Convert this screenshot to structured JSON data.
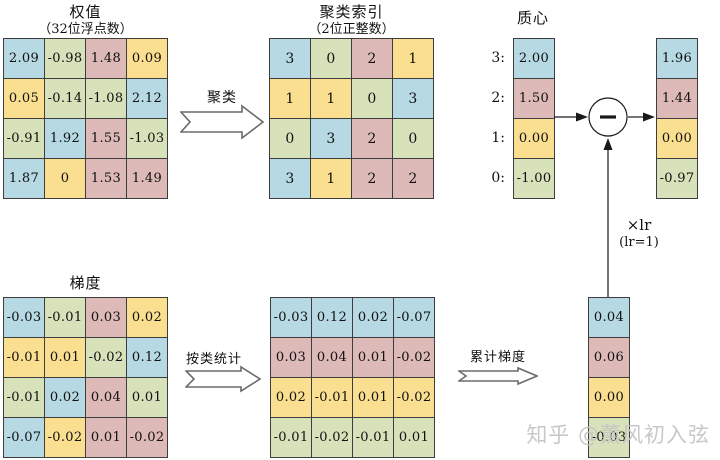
{
  "colors": {
    "blue": "#b6d9e3",
    "green": "#d7e2ba",
    "pink": "#ddb9b8",
    "yellow": "#fbdf90"
  },
  "weights": {
    "title": "权值",
    "subtitle": "（32位浮点数）",
    "cells": [
      [
        {
          "v": "2.09",
          "c": "blue"
        },
        {
          "v": "-0.98",
          "c": "green"
        },
        {
          "v": "1.48",
          "c": "pink"
        },
        {
          "v": "0.09",
          "c": "yellow"
        }
      ],
      [
        {
          "v": "0.05",
          "c": "yellow"
        },
        {
          "v": "-0.14",
          "c": "green"
        },
        {
          "v": "-1.08",
          "c": "green"
        },
        {
          "v": "2.12",
          "c": "blue"
        }
      ],
      [
        {
          "v": "-0.91",
          "c": "green"
        },
        {
          "v": "1.92",
          "c": "blue"
        },
        {
          "v": "1.55",
          "c": "pink"
        },
        {
          "v": "-1.03",
          "c": "green"
        }
      ],
      [
        {
          "v": "1.87",
          "c": "blue"
        },
        {
          "v": "0",
          "c": "yellow"
        },
        {
          "v": "1.53",
          "c": "pink"
        },
        {
          "v": "1.49",
          "c": "pink"
        }
      ]
    ]
  },
  "cluster_index": {
    "title": "聚类索引",
    "subtitle": "（2位正整数）",
    "cells": [
      [
        {
          "v": "3",
          "c": "blue"
        },
        {
          "v": "0",
          "c": "green"
        },
        {
          "v": "2",
          "c": "pink"
        },
        {
          "v": "1",
          "c": "yellow"
        }
      ],
      [
        {
          "v": "1",
          "c": "yellow"
        },
        {
          "v": "1",
          "c": "yellow"
        },
        {
          "v": "0",
          "c": "green"
        },
        {
          "v": "3",
          "c": "blue"
        }
      ],
      [
        {
          "v": "0",
          "c": "green"
        },
        {
          "v": "3",
          "c": "blue"
        },
        {
          "v": "2",
          "c": "pink"
        },
        {
          "v": "0",
          "c": "green"
        }
      ],
      [
        {
          "v": "3",
          "c": "blue"
        },
        {
          "v": "1",
          "c": "yellow"
        },
        {
          "v": "2",
          "c": "pink"
        },
        {
          "v": "2",
          "c": "pink"
        }
      ]
    ]
  },
  "centroids": {
    "title": "质心",
    "labels": [
      "3:",
      "2:",
      "1:",
      "0:"
    ],
    "cells": [
      [
        {
          "v": "2.00",
          "c": "blue"
        }
      ],
      [
        {
          "v": "1.50",
          "c": "pink"
        }
      ],
      [
        {
          "v": "0.00",
          "c": "yellow"
        }
      ],
      [
        {
          "v": "-1.00",
          "c": "green"
        }
      ]
    ]
  },
  "updated_centroids": {
    "cells": [
      [
        {
          "v": "1.96",
          "c": "blue"
        }
      ],
      [
        {
          "v": "1.44",
          "c": "pink"
        }
      ],
      [
        {
          "v": "0.00",
          "c": "yellow"
        }
      ],
      [
        {
          "v": "-0.97",
          "c": "green"
        }
      ]
    ]
  },
  "gradients": {
    "title": "梯度",
    "cells": [
      [
        {
          "v": "-0.03",
          "c": "blue"
        },
        {
          "v": "-0.01",
          "c": "green"
        },
        {
          "v": "0.03",
          "c": "pink"
        },
        {
          "v": "0.02",
          "c": "yellow"
        }
      ],
      [
        {
          "v": "-0.01",
          "c": "yellow"
        },
        {
          "v": "0.01",
          "c": "yellow"
        },
        {
          "v": "-0.02",
          "c": "green"
        },
        {
          "v": "0.12",
          "c": "blue"
        }
      ],
      [
        {
          "v": "-0.01",
          "c": "green"
        },
        {
          "v": "0.02",
          "c": "blue"
        },
        {
          "v": "0.04",
          "c": "pink"
        },
        {
          "v": "0.01",
          "c": "green"
        }
      ],
      [
        {
          "v": "-0.07",
          "c": "blue"
        },
        {
          "v": "-0.02",
          "c": "yellow"
        },
        {
          "v": "0.01",
          "c": "pink"
        },
        {
          "v": "-0.02",
          "c": "pink"
        }
      ]
    ]
  },
  "grouped_gradients": {
    "cells": [
      [
        {
          "v": "-0.03",
          "c": "blue"
        },
        {
          "v": "0.12",
          "c": "blue"
        },
        {
          "v": "0.02",
          "c": "blue"
        },
        {
          "v": "-0.07",
          "c": "blue"
        }
      ],
      [
        {
          "v": "0.03",
          "c": "pink"
        },
        {
          "v": "0.04",
          "c": "pink"
        },
        {
          "v": "0.01",
          "c": "pink"
        },
        {
          "v": "-0.02",
          "c": "pink"
        }
      ],
      [
        {
          "v": "0.02",
          "c": "yellow"
        },
        {
          "v": "-0.01",
          "c": "yellow"
        },
        {
          "v": "0.01",
          "c": "yellow"
        },
        {
          "v": "-0.02",
          "c": "yellow"
        }
      ],
      [
        {
          "v": "-0.01",
          "c": "green"
        },
        {
          "v": "-0.02",
          "c": "green"
        },
        {
          "v": "-0.01",
          "c": "green"
        },
        {
          "v": "0.01",
          "c": "green"
        }
      ]
    ]
  },
  "accumulated_gradients": {
    "cells": [
      [
        {
          "v": "0.04",
          "c": "blue"
        }
      ],
      [
        {
          "v": "0.06",
          "c": "pink"
        }
      ],
      [
        {
          "v": "0.00",
          "c": "yellow"
        }
      ],
      [
        {
          "v": "-0.03",
          "c": "green"
        }
      ]
    ]
  },
  "arrows": {
    "cluster_label": "聚类",
    "group_label": "按类统计",
    "accumulate_label": "累计梯度"
  },
  "operator": {
    "lr_label": "×lr",
    "lr_note": "(lr=1)"
  },
  "watermark": "知乎 @薰风初入弦"
}
